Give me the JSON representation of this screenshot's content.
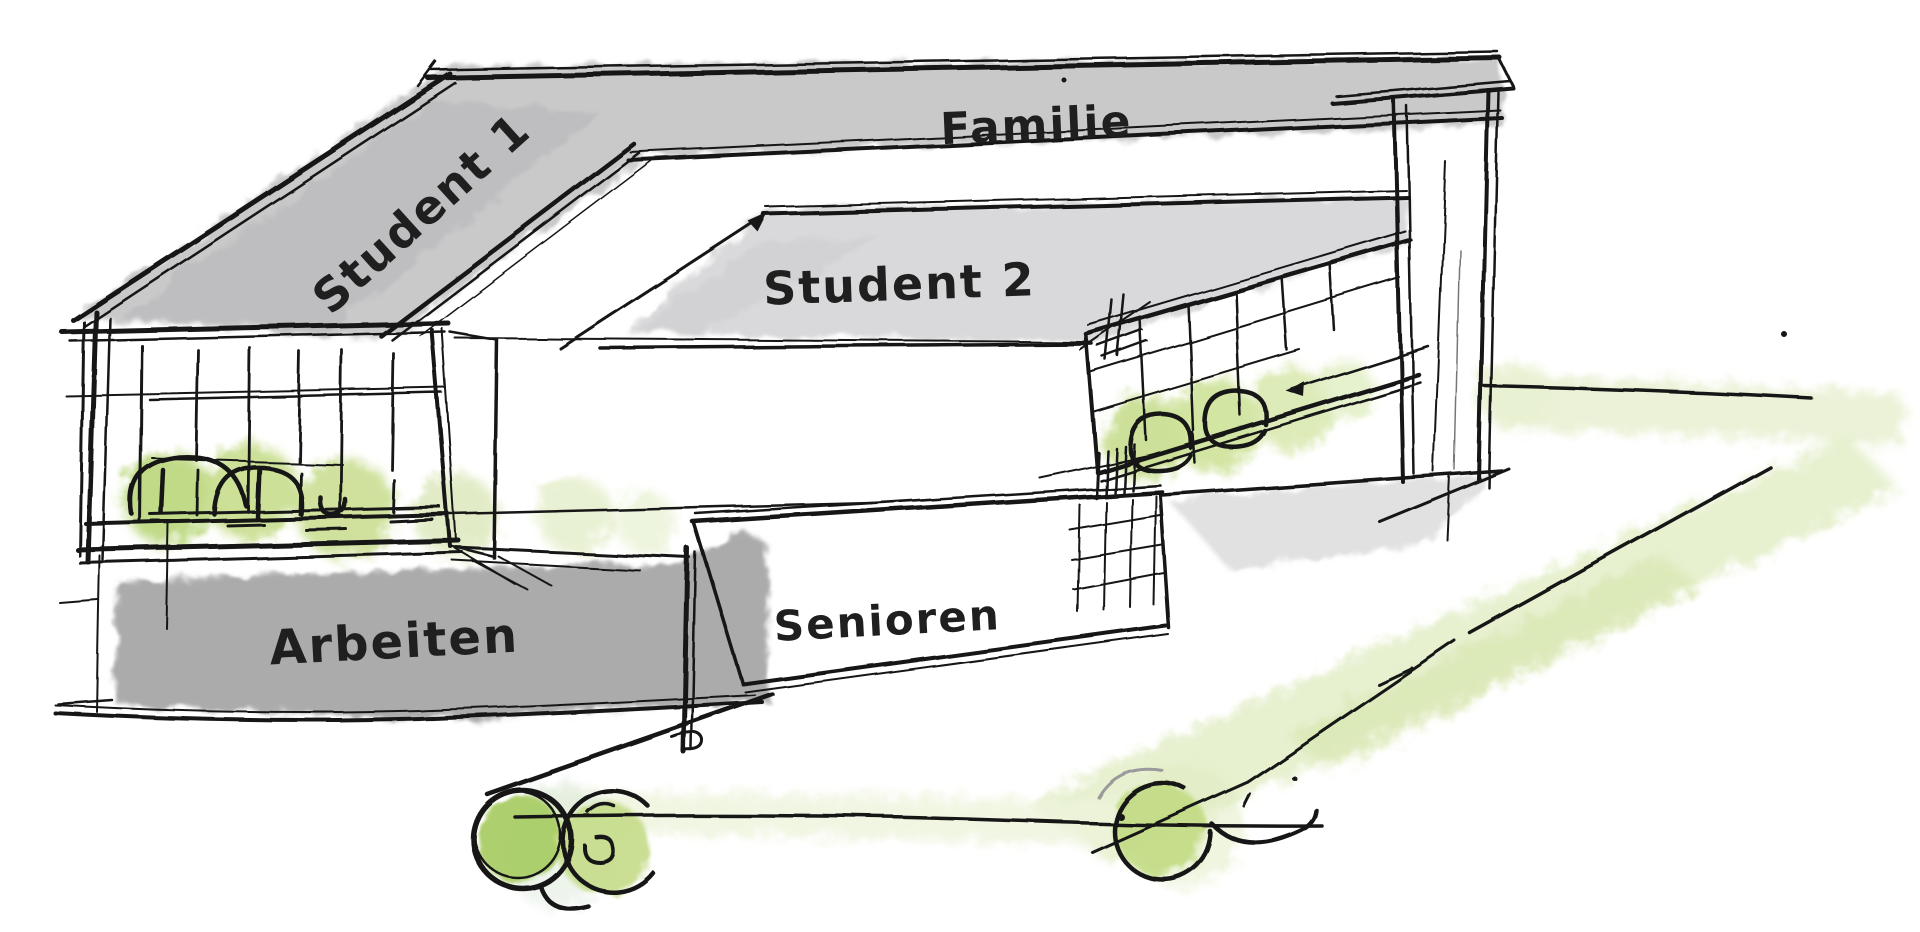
{
  "sketch": {
    "kind": "hand-drawn architectural concept sketch",
    "areas": [
      {
        "id": "student1",
        "label": "Student 1"
      },
      {
        "id": "familie",
        "label": "Familie"
      },
      {
        "id": "student2",
        "label": "Student 2"
      },
      {
        "id": "arbeiten",
        "label": "Arbeiten"
      },
      {
        "id": "senioren",
        "label": "Senioren"
      }
    ],
    "colors": {
      "ink": "#181818",
      "roof_gray": "#c4c4c6",
      "roof_gray_light": "#d7d7d9",
      "band_gray_dark": "#a6a6a8",
      "shadow_gray": "#c9c9cb",
      "green_bright": "#a9cc65",
      "green_mid": "#c6dd8e",
      "green_pale": "#e3eec8",
      "green_faint": "#eef4dc",
      "background": "#ffffff"
    }
  }
}
